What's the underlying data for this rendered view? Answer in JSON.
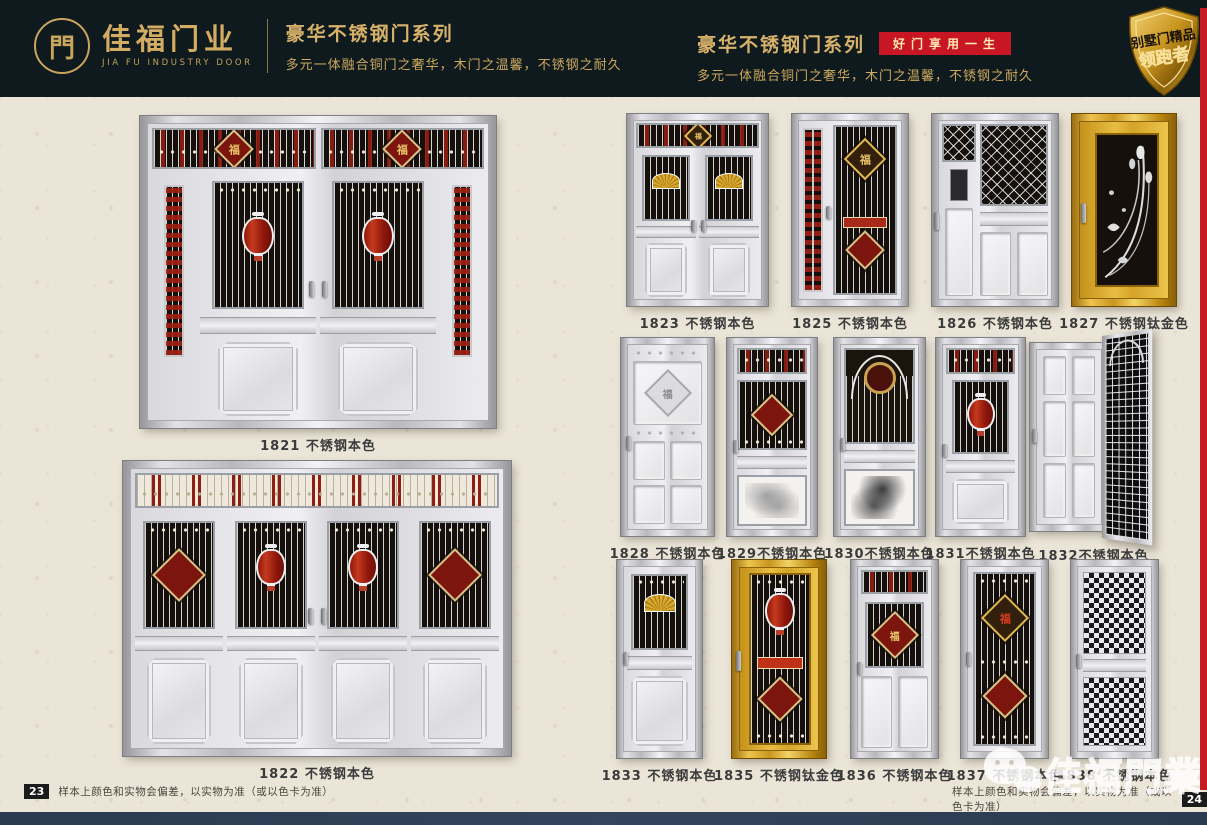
{
  "header": {
    "logo": {
      "glyph": "門",
      "brand_cn": "佳福门业",
      "brand_en": "JIA FU INDUSTRY DOOR"
    },
    "series_left": {
      "title": "豪华不锈钢门系列",
      "subtitle": "多元一体融合铜门之奢华，木门之温馨，不锈钢之耐久"
    },
    "series_right": {
      "title": "豪华不锈钢门系列",
      "badge": "好门享用一生",
      "subtitle": "多元一体融合铜门之奢华，木门之温馨，不锈钢之耐久"
    },
    "emblem": {
      "line1": "别墅门精品",
      "line2": "领跑者"
    }
  },
  "left_page": {
    "doors": [
      {
        "model": "1821",
        "label": "1821 不锈钢本色"
      },
      {
        "model": "1822",
        "label": "1822 不锈钢本色"
      }
    ],
    "footer": {
      "page": "23",
      "note": "样本上颜色和实物会偏差，以实物为准（或以色卡为准）"
    }
  },
  "right_page": {
    "row1": [
      {
        "label": "1823 不锈钢本色"
      },
      {
        "label": "1825 不锈钢本色"
      },
      {
        "label": "1826 不锈钢本色"
      },
      {
        "label": "1827 不锈钢钛金色"
      }
    ],
    "row2": [
      {
        "label": "1828 不锈钢本色"
      },
      {
        "label": "1829不锈钢本色"
      },
      {
        "label": "1830不锈钢本色"
      },
      {
        "label": "1831不锈钢本色"
      },
      {
        "label": "1832不锈钢本色"
      }
    ],
    "row3": [
      {
        "label": "1833 不锈钢本色"
      },
      {
        "label": "1835 不锈钢钛金色"
      },
      {
        "label": "1836 不锈钢本色"
      },
      {
        "label": "1837 不锈钢本色"
      },
      {
        "label": "1838 不锈钢本色"
      }
    ],
    "footer": {
      "note": "样本上颜色和实物会偏差，以实物为准（或以色卡为准）",
      "page": "24"
    }
  },
  "watermark": {
    "brand": "佳福門業"
  },
  "decor": {
    "fu": "福"
  },
  "colors": {
    "header_bg": "#0e1a1d",
    "gold": "#d4ab62",
    "badge_red": "#c91624",
    "page_bg": "#ebe5d8",
    "accent_red": "#8e1d12",
    "titanium_gold": "#d9a92f",
    "bottom_bar": "#2e3d53",
    "edge_strip": "#c41a22"
  }
}
